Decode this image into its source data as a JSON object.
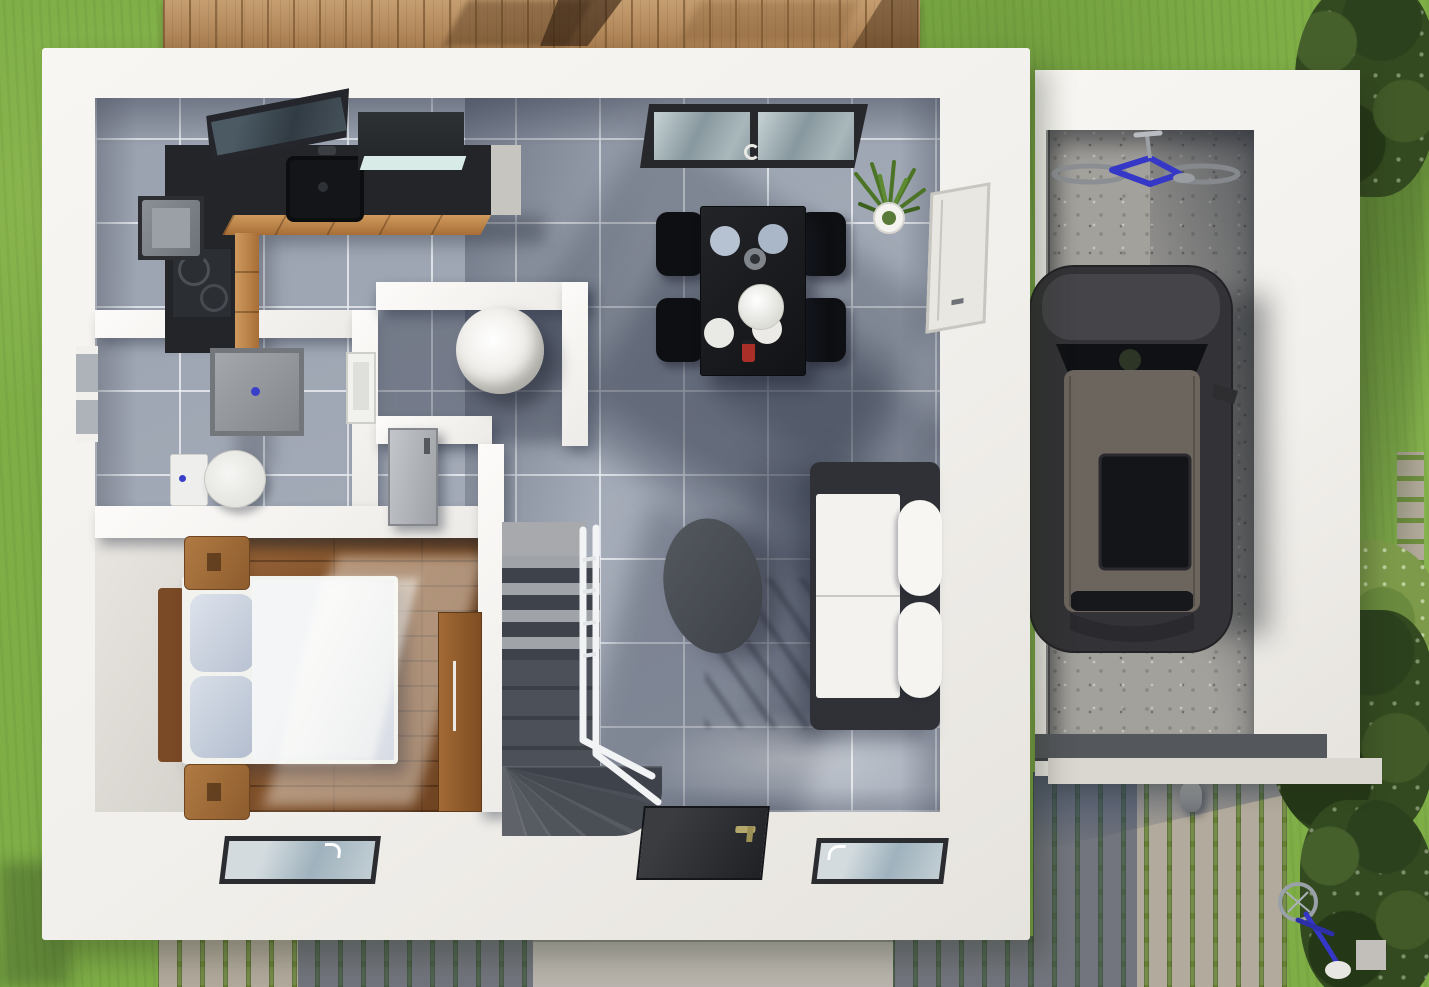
{
  "title": "3D top-down floor plan render of a single-family house with garage and garden",
  "colors": {
    "grass": "#7fae47",
    "deck_wood": "#b5895a",
    "house_wall": "#f2f0ec",
    "tile": "#a6adb9",
    "wood_floor": "#7e4e28",
    "counter": "#232529",
    "cabinet_wood": "#c08445",
    "table_black": "#17181b",
    "chair_black": "#0e0f12",
    "sofa_frame": "#2f3136",
    "cushion": "#f3f2ef",
    "coffee_table": "#474b51",
    "stairs_dark": "#41454b",
    "stairs_light": "#9fa2a6",
    "railing": "#f1f3f5",
    "concrete": "#a3a19c",
    "car_body": "#333236",
    "car_roof": "#6c655e",
    "glass_dark": "#141519",
    "cobble": "#b2aa9c",
    "cobble_joint": "#677f35",
    "garage_door": "#54575c",
    "door_dark": "#2b2d30",
    "window_frame": "#2a2c2f",
    "plant_green": "#4c7427",
    "bike_blue": "#3538c6",
    "accent_blue": "#3a3fc9",
    "fixture_white": "#f1f1ef",
    "shower_gray": "#95989c",
    "bed_duvet": "#eceef1",
    "pillow": "#c5cdda",
    "headboard": "#7a4a26",
    "nightstand": "#a06b3a",
    "wardrobe": "#9a6330",
    "plate_blue": "#b6c2d2",
    "bowl_white": "#f1f1ee",
    "red_item": "#a92f28"
  },
  "scene": {
    "type": "3d-floor-plan-render",
    "view": "top-down",
    "house": {
      "rooms": [
        {
          "name": "kitchen",
          "contents": [
            "l-shaped-dark-counter",
            "sink-with-faucet",
            "cooktop-with-burners",
            "range-hood",
            "refrigerator",
            "wood-cabinet-fronts",
            "tilted-roof-window"
          ]
        },
        {
          "name": "dining-area",
          "contents": [
            "black-dining-table",
            "four-black-chairs",
            "four-plates",
            "white-serving-bowl",
            "gray-vase",
            "red-condiment",
            "roof-window",
            "potted-plant",
            "side-wall-window"
          ]
        },
        {
          "name": "bathroom",
          "contents": [
            "shower-tray-with-drain",
            "toilet",
            "wall-sink",
            "exterior-window"
          ]
        },
        {
          "name": "hallway-wc",
          "contents": [
            "round-white-table",
            "open-gray-door",
            "closet-nook"
          ]
        },
        {
          "name": "bedroom",
          "contents": [
            "double-bed",
            "two-pillows",
            "wood-headboard",
            "two-nightstands",
            "wardrobe",
            "plank-wood-floor",
            "facade-window"
          ]
        },
        {
          "name": "living-room",
          "contents": [
            "white-sofa-dark-frame",
            "oval-coffee-table",
            "front-door",
            "facade-window",
            "winder-staircase",
            "white-railing",
            "gray-tile-floor"
          ]
        }
      ]
    },
    "garage": {
      "contents": [
        "dark-gray-car-with-sunroof",
        "blue-bicycle-parked",
        "garage-door",
        "concrete-floor"
      ]
    },
    "outdoor": {
      "contents": [
        "wooden-deck-terrace",
        "lawn",
        "cobblestone-driveway",
        "concrete-entry-pad",
        "stepping-stone-path",
        "shrubs-and-trees",
        "leaning-blue-bicycle",
        "stone-bollard"
      ]
    }
  }
}
